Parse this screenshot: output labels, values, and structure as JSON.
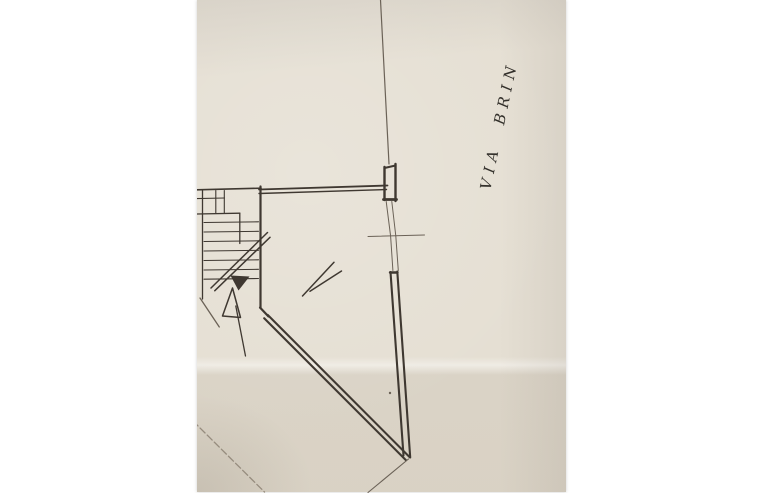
{
  "label": {
    "text": "VIA BRIN",
    "rotation_deg": -78
  },
  "colors": {
    "paper": "#e5dfd3",
    "margin": "#ffffff",
    "ink": "#3f3831",
    "ink_mid": "#6b6257",
    "ink_light": "#968c7e"
  },
  "plan": {
    "segments": [
      {
        "n": "street-boundary-line",
        "x1": 183.5,
        "y1": 0,
        "x2": 192,
        "y2": 164,
        "w": 1.2,
        "c": "ink_mid"
      },
      {
        "n": "street-pier-wall-left",
        "x1": 187.5,
        "y1": 167,
        "x2": 187.5,
        "y2": 200,
        "w": 2.4
      },
      {
        "n": "street-pier-wall-right",
        "x1": 198.5,
        "y1": 164,
        "x2": 198.5,
        "y2": 201,
        "w": 2.4
      },
      {
        "n": "street-pier-wall-top",
        "x1": 187.5,
        "y1": 168,
        "x2": 198.5,
        "y2": 165.5,
        "w": 2
      },
      {
        "n": "street-pier-wall-bottom",
        "x1": 186.5,
        "y1": 199.5,
        "x2": 199.5,
        "y2": 199.5,
        "w": 2.8
      },
      {
        "n": "room-top-wall-outer",
        "x1": 62,
        "y1": 189.5,
        "x2": 190.5,
        "y2": 185.5,
        "w": 1.8
      },
      {
        "n": "room-top-wall-inner",
        "x1": 62,
        "y1": 193.5,
        "x2": 189.5,
        "y2": 189.5,
        "w": 1.4
      },
      {
        "n": "room-left-wall",
        "x1": 63.5,
        "y1": 186.5,
        "x2": 63.5,
        "y2": 308,
        "w": 2.2
      },
      {
        "n": "room-wall-bend",
        "x1": 63,
        "y1": 307.5,
        "x2": 71.5,
        "y2": 316.5,
        "w": 2.2
      },
      {
        "n": "diagonal-wall-outer",
        "x1": 70.8,
        "y1": 315,
        "x2": 212.5,
        "y2": 457,
        "w": 2.1
      },
      {
        "n": "diagonal-wall-inner",
        "x1": 67.2,
        "y1": 318.3,
        "x2": 209,
        "y2": 460.2,
        "w": 2.1
      },
      {
        "n": "street-wall-lower-outer",
        "x1": 200.3,
        "y1": 271.5,
        "x2": 213.2,
        "y2": 457.5,
        "w": 2.1
      },
      {
        "n": "street-wall-lower-inner",
        "x1": 193.5,
        "y1": 272,
        "x2": 206.5,
        "y2": 455.5,
        "w": 2.1
      },
      {
        "n": "street-wall-lower-cap",
        "x1": 193,
        "y1": 272.5,
        "x2": 200.5,
        "y2": 272.5,
        "w": 2.4
      },
      {
        "n": "window-opening-line-1",
        "x1": 189.2,
        "y1": 201.5,
        "x2": 193.6,
        "y2": 236,
        "w": 1,
        "c": "ink_mid"
      },
      {
        "n": "window-opening-line-2",
        "x1": 194.8,
        "y1": 201.5,
        "x2": 198.8,
        "y2": 236,
        "w": 1,
        "c": "ink_mid"
      },
      {
        "n": "window-opening-line-3",
        "x1": 193.6,
        "y1": 236,
        "x2": 195.9,
        "y2": 270.5,
        "w": 1,
        "c": "ink_mid"
      },
      {
        "n": "window-opening-line-4",
        "x1": 198.8,
        "y1": 236,
        "x2": 201.3,
        "y2": 270.5,
        "w": 1,
        "c": "ink_mid"
      },
      {
        "n": "window-center-tick",
        "x1": 171,
        "y1": 236.5,
        "x2": 227.5,
        "y2": 235,
        "w": 1,
        "c": "ink_mid"
      },
      {
        "n": "stairwell-top-wall",
        "x1": 0,
        "y1": 189.8,
        "x2": 64,
        "y2": 188.2,
        "w": 1.6
      },
      {
        "n": "stairwell-left-wall",
        "x1": 5.5,
        "y1": 190,
        "x2": 5.5,
        "y2": 299,
        "w": 1.3
      },
      {
        "n": "stair-landing-step-line",
        "x1": 0,
        "y1": 198.6,
        "x2": 27.5,
        "y2": 198,
        "w": 1.1
      },
      {
        "n": "stair-landing-divider-1",
        "x1": 18.8,
        "y1": 190.5,
        "x2": 18.8,
        "y2": 213.5,
        "w": 1.1
      },
      {
        "n": "stair-landing-divider-2",
        "x1": 27.3,
        "y1": 190.5,
        "x2": 27.3,
        "y2": 213.5,
        "w": 1.1
      },
      {
        "n": "stair-landing-edge",
        "x1": 0,
        "y1": 214,
        "x2": 42.8,
        "y2": 213.2,
        "w": 1.3
      },
      {
        "n": "stair-landing-side",
        "x1": 42.8,
        "y1": 213.2,
        "x2": 42.8,
        "y2": 243.5,
        "w": 1.3
      },
      {
        "n": "stair-tread-1",
        "x1": 7,
        "y1": 222.5,
        "x2": 61.5,
        "y2": 221.8,
        "w": 1.05
      },
      {
        "n": "stair-tread-2",
        "x1": 7,
        "y1": 232,
        "x2": 61.5,
        "y2": 231.3,
        "w": 1.05
      },
      {
        "n": "stair-tread-3",
        "x1": 7,
        "y1": 241.5,
        "x2": 61.5,
        "y2": 240.8,
        "w": 1.05
      },
      {
        "n": "stair-tread-4",
        "x1": 7,
        "y1": 251,
        "x2": 61.5,
        "y2": 250.3,
        "w": 1.05
      },
      {
        "n": "stair-tread-5",
        "x1": 7,
        "y1": 260.5,
        "x2": 61.5,
        "y2": 259.8,
        "w": 1.05
      },
      {
        "n": "stair-tread-6",
        "x1": 7,
        "y1": 270,
        "x2": 61.5,
        "y2": 269.3,
        "w": 1.05
      },
      {
        "n": "stair-tread-7",
        "x1": 7,
        "y1": 279.2,
        "x2": 61.5,
        "y2": 278.5,
        "w": 1.05
      },
      {
        "n": "stair-run-line-a",
        "x1": 14,
        "y1": 288,
        "x2": 70.5,
        "y2": 232.5,
        "w": 1.5
      },
      {
        "n": "stair-run-line-b",
        "x1": 17.8,
        "y1": 290.7,
        "x2": 73,
        "y2": 237.3,
        "w": 1.5
      },
      {
        "n": "edge-diagonal-line",
        "x1": 3,
        "y1": 298,
        "x2": 22.3,
        "y2": 327,
        "w": 1.3,
        "c": "ink_mid"
      },
      {
        "n": "pencil-check-mark-a",
        "x1": 105.5,
        "y1": 296,
        "x2": 137,
        "y2": 262.3,
        "w": 1.5
      },
      {
        "n": "pencil-check-mark-b",
        "x1": 113,
        "y1": 291.3,
        "x2": 144.5,
        "y2": 271,
        "w": 1.5
      },
      {
        "n": "stair-direction-arrow-shaft",
        "x1": 38.8,
        "y1": 306,
        "x2": 48.5,
        "y2": 356,
        "w": 1.3
      },
      {
        "n": "lot-boundary-line",
        "x1": -4,
        "y1": 421,
        "x2": 67.5,
        "y2": 492,
        "w": 1.3,
        "c": "ink_light",
        "dash": "7 3"
      },
      {
        "n": "wall-extension-line",
        "x1": 211.5,
        "y1": 459,
        "x2": 171,
        "y2": 492.5,
        "w": 1.1,
        "c": "ink_mid"
      }
    ],
    "shapes": [
      {
        "n": "stair-direction-arrowhead-filled",
        "kind": "polygon",
        "points": "33.5,275.5 52.5,276.5 41.5,290.5",
        "fill": "ink"
      },
      {
        "n": "stair-direction-arrowhead-open",
        "kind": "polygon",
        "points": "35.5,288 25.5,316 43.5,317.5",
        "stroke": "ink",
        "w": 1.5
      },
      {
        "n": "paper-speckle-dot",
        "kind": "circle",
        "cx": 193,
        "cy": 393,
        "r": 1.2,
        "fill": "ink_mid"
      }
    ]
  }
}
